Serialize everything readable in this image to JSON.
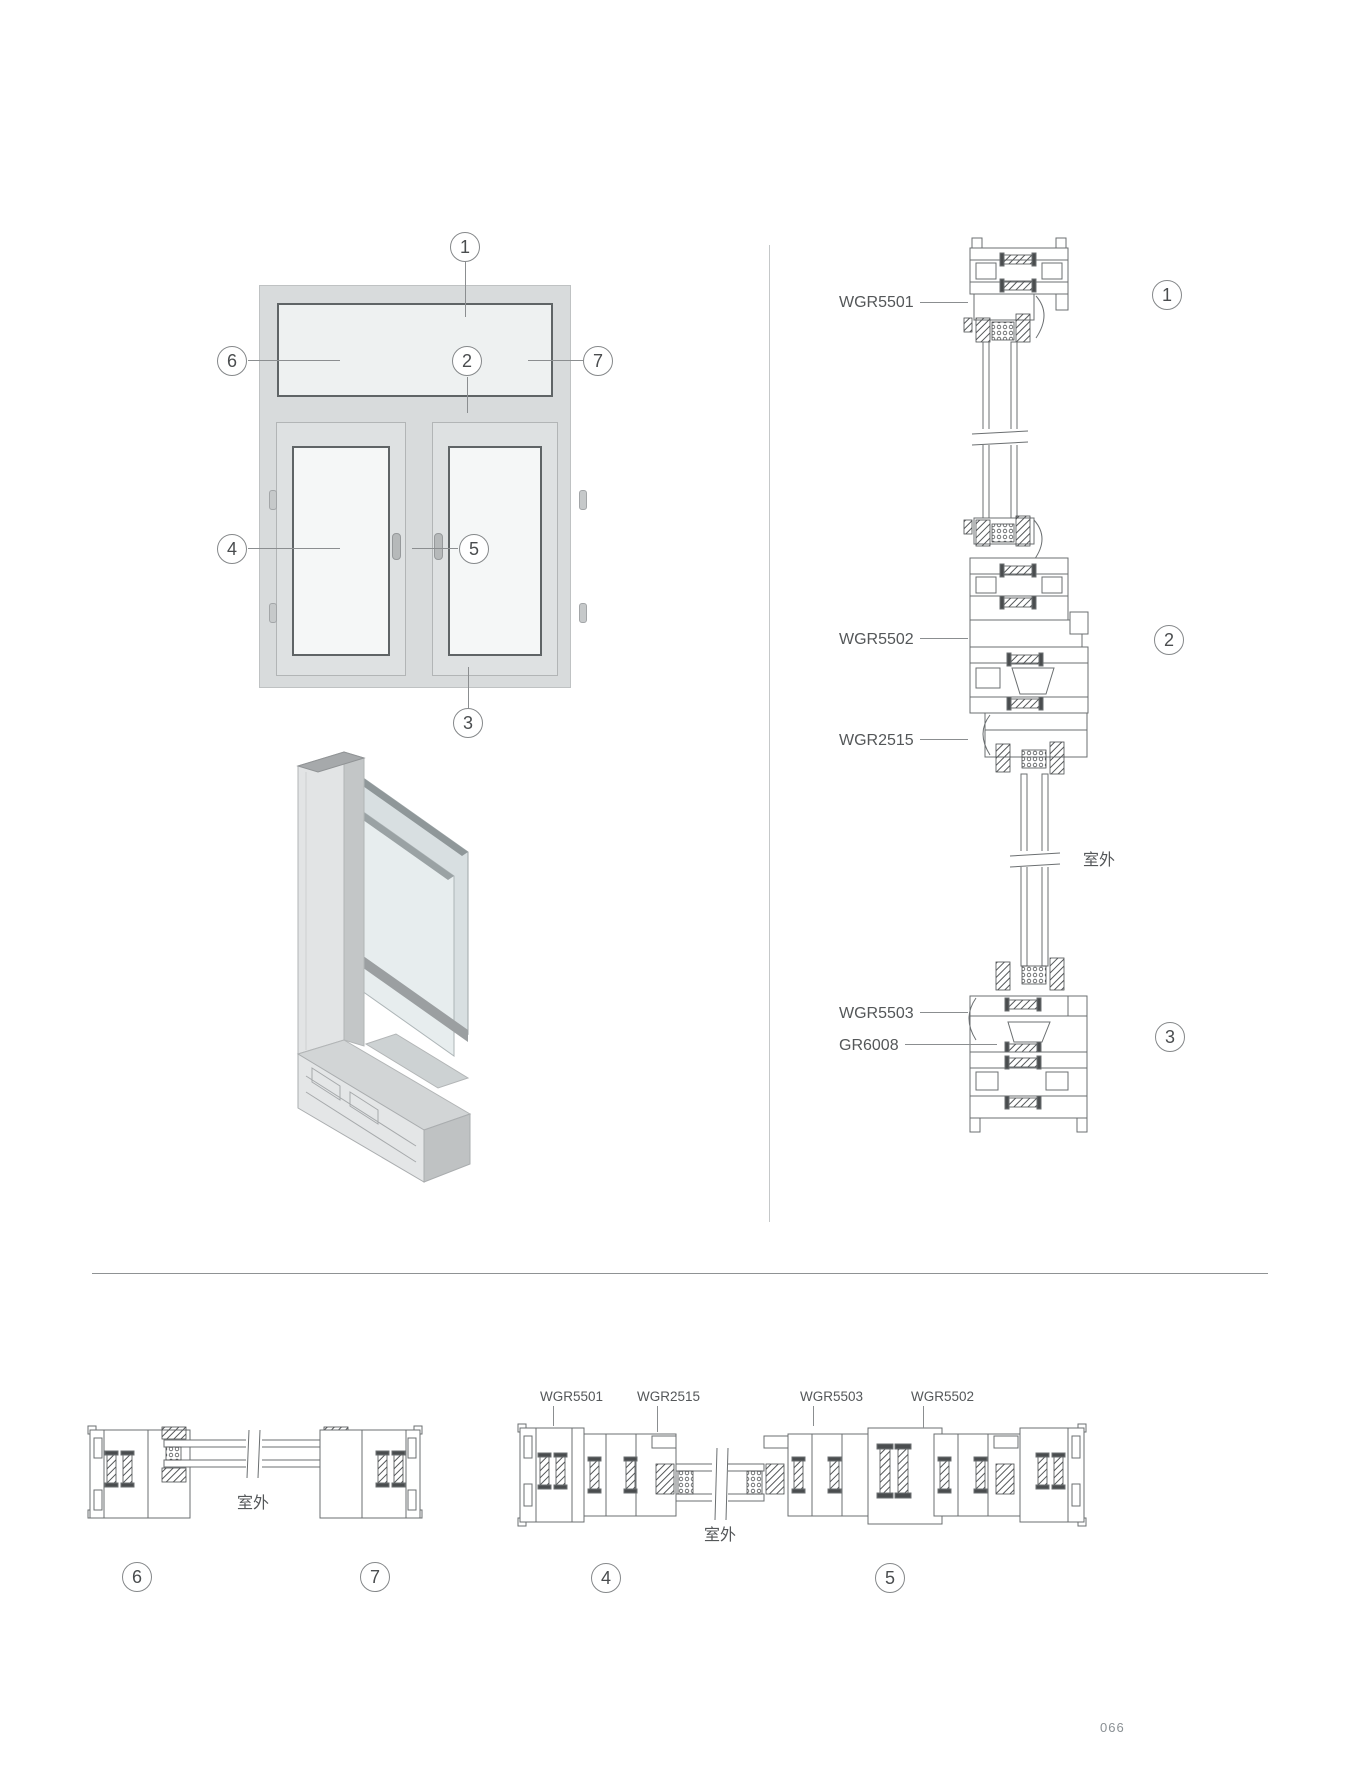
{
  "page": {
    "number": "066"
  },
  "colors": {
    "line": "#6b6f71",
    "label_text": "#545759",
    "hatch_dark": "#4a4d4f",
    "leader": "#8b8e90",
    "frame_fill": "#d8dbdc",
    "glass_fill": "#f5f7f7"
  },
  "elevation": {
    "callouts": {
      "c1": "1",
      "c2": "2",
      "c3": "3",
      "c4": "4",
      "c5": "5",
      "c6": "6",
      "c7": "7"
    }
  },
  "vertical_section": {
    "wgr5501": "WGR5501",
    "wgr5502": "WGR5502",
    "wgr2515": "WGR2515",
    "wgr5503": "WGR5503",
    "gr6008": "GR6008",
    "outside": "室外",
    "c1": "1",
    "c2": "2",
    "c3": "3"
  },
  "section_66_77": {
    "outside": "室外",
    "c6": "6",
    "c7": "7"
  },
  "section_44_55": {
    "wgr5501": "WGR5501",
    "wgr2515": "WGR2515",
    "wgr5503": "WGR5503",
    "wgr5502": "WGR5502",
    "outside": "室外",
    "c4": "4",
    "c5": "5"
  }
}
